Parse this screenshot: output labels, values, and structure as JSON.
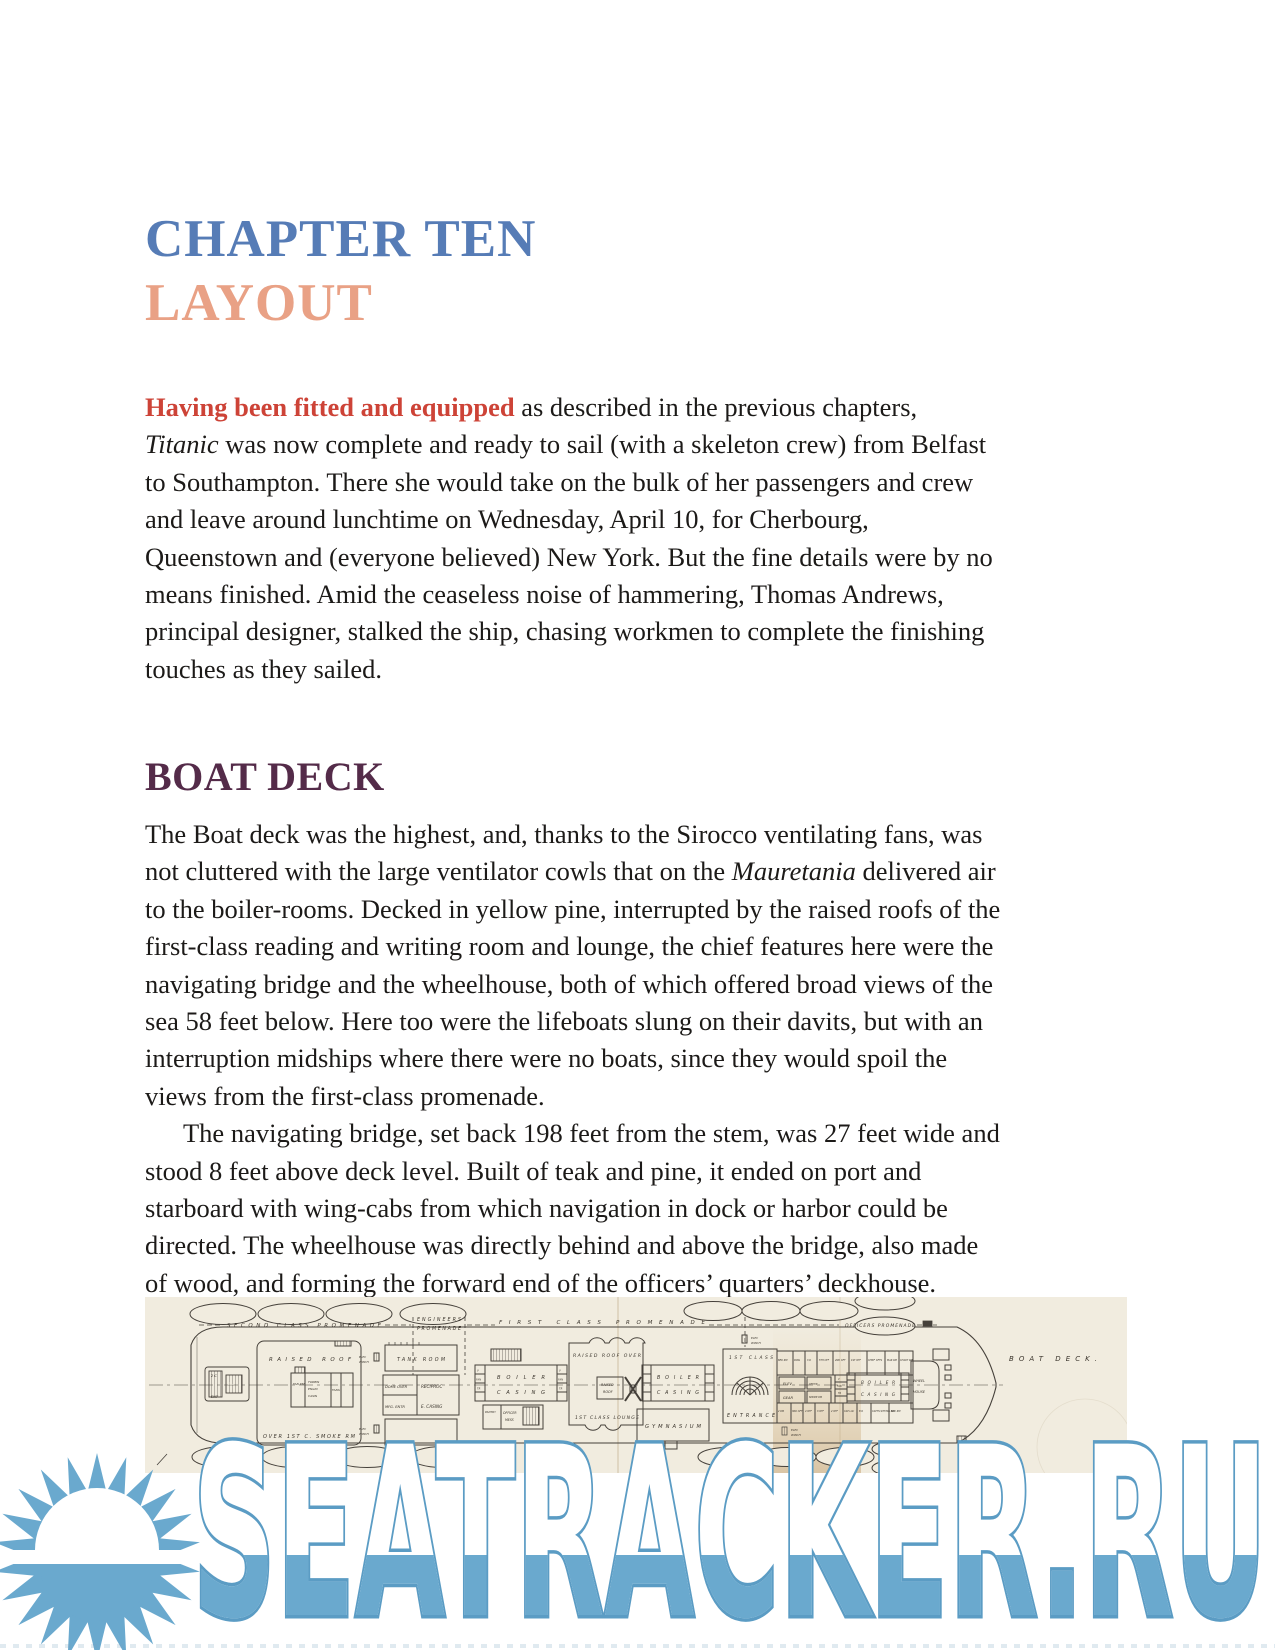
{
  "page": {
    "chapter_title": "CHAPTER TEN",
    "chapter_subtitle": "LAYOUT",
    "section_heading": "BOAT DECK"
  },
  "paragraphs": [
    {
      "name": "paragraph-intro",
      "indent_first": false,
      "lines": [
        [
          {
            "t": "Having been fitted and equipped",
            "c": "lead"
          },
          {
            "t": " as described in the previous chapters,"
          }
        ],
        [
          {
            "t": "Titanic",
            "c": "i"
          },
          {
            "t": " was now complete and ready to sail (with a skeleton crew) from Belfast"
          }
        ],
        "to Southampton. There she would take on the bulk of her passengers and crew",
        "and leave around lunchtime on Wednesday, April 10, for Cherbourg,",
        "Queenstown and (everyone believed) New York. But the fine details were by no",
        "means finished. Amid the ceaseless noise of hammering, Thomas Andrews,",
        "principal designer, stalked the ship, chasing workmen to complete the finishing",
        "touches as they sailed."
      ]
    },
    {
      "name": "paragraph-boatdeck-1",
      "indent_first": false,
      "lines": [
        "The Boat deck was the highest, and, thanks to the Sirocco ventilating fans, was",
        [
          {
            "t": "not cluttered with the large ventilator cowls that on the "
          },
          {
            "t": "Mauretania",
            "c": "i"
          },
          {
            "t": " delivered air"
          }
        ],
        "to the boiler-rooms. Decked in yellow pine, interrupted by the raised roofs of the",
        "first-class reading and writing room and lounge, the chief features here were the",
        "navigating bridge and the wheelhouse, both of which offered broad views of the",
        "sea 58 feet below. Here too were the lifeboats slung on their davits, but with an",
        "interruption midships where there were no boats, since they would spoil the",
        "views from the first-class promenade."
      ]
    },
    {
      "name": "paragraph-boatdeck-2",
      "indent_first": true,
      "lines": [
        "The navigating bridge, set back 198 feet from the stem, was 27 feet wide and",
        "stood 8 feet above deck level. Built of teak and pine, it ended on port and",
        "starboard with wing-cabs from which navigation in dock or harbor could be",
        "directed. The wheelhouse was directly behind and above the bridge, also made",
        "of wood, and forming the forward end of the officers’ quarters’ deckhouse."
      ]
    }
  ],
  "deck_plan": {
    "labels": {
      "second_class_promenade": "SECOND CLASS PROMENADE",
      "engineers": "ENGINEERS",
      "promenade": "PROMENADE",
      "first_class_promenade": "FIRST CLASS PROMENADE",
      "officers_promenade": "OFFICERS PROMENADE",
      "boat_deck": "BOAT DECK.",
      "raised_roof": "RAISED ROOF",
      "over_smoke": "OVER 1ST C. SMOKE RM",
      "tank_room": "TANK ROOM",
      "dome_over": "DOME OVER",
      "mfg_entr": "MFG. ENTR",
      "reciproc": "RECIPROC",
      "e_casing": "E. CASING",
      "elec": "ELEC",
      "winch": "WINCH",
      "boiler": "BOILER",
      "casing": "CASING",
      "raised_roof_over": "RAISED ROOF OVER",
      "raised": "RAISED",
      "roof": "ROOF",
      "first_class_lounge": "1ST CLASS LOUNGE",
      "gymnasium": "GYMNASIUM",
      "first_class": "1ST CLASS",
      "entrance": "ENTRANCE",
      "elev": "ELEV",
      "gear": "GEAR",
      "office": "OFFICE",
      "smoke_room": "SMOKE RM",
      "officer": "OFFICER",
      "mess": "MESS",
      "pantry": "PANTRY",
      "deck_chairs": "DECK CHAIRS",
      "wheel": "WHEEL",
      "house": "HOUSE",
      "elevator_2c": "2 C",
      "elevator_ele": "ELE",
      "elevator_ent": "ENT",
      "fan_room": "FAN RM",
      "turbin": "TURBIN",
      "engin": "ENGIN",
      "casin": "CASIN",
      "fans": "FANS",
      "v": "V",
      "fan": "FAN",
      "tr": "TR",
      "officers_top": [
        "BED RM",
        "PASS",
        "3 R",
        "5TH OFF",
        "2ND OFF",
        "1ST OFF",
        "CHIEF OFFS",
        "MAR RM",
        "CHART RM"
      ],
      "officers_bottom": [
        "2 RM",
        "3RD OFF",
        "4 OFF",
        "3 OFF",
        "2 OFF",
        "CAP LAV",
        "B R",
        "CAPTS SITTING RM",
        "NAV RM"
      ]
    },
    "colors": {
      "paper": "#f1ecdf",
      "ink": "#45403a",
      "label_ink": "#3a342c",
      "stain": "#c8a36a"
    }
  },
  "watermark": {
    "text": "SEATRACKER.RU",
    "fill_color": "#6aa9ce",
    "outline_color": "#5b9cc4"
  }
}
